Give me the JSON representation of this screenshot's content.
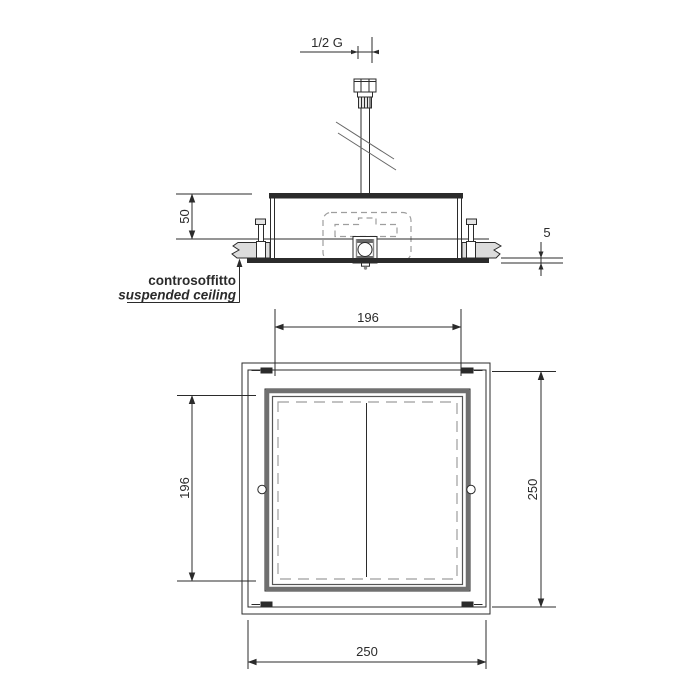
{
  "labels": {
    "thread_size": "1/2 G",
    "ceiling_it": "controsoffitto",
    "ceiling_en": "suspended ceiling"
  },
  "dimensions": {
    "recess_depth": "50",
    "flange_projection": "5",
    "cutout_width": "196",
    "cutout_height": "196",
    "plate_width": "250",
    "plate_height": "250"
  },
  "colors": {
    "line": "#2b2b2b",
    "hidden_line": "#9e9e9e",
    "frame_gray": "#6f6f6f",
    "ceiling_fill": "#dcdcdc",
    "background": "#ffffff"
  }
}
